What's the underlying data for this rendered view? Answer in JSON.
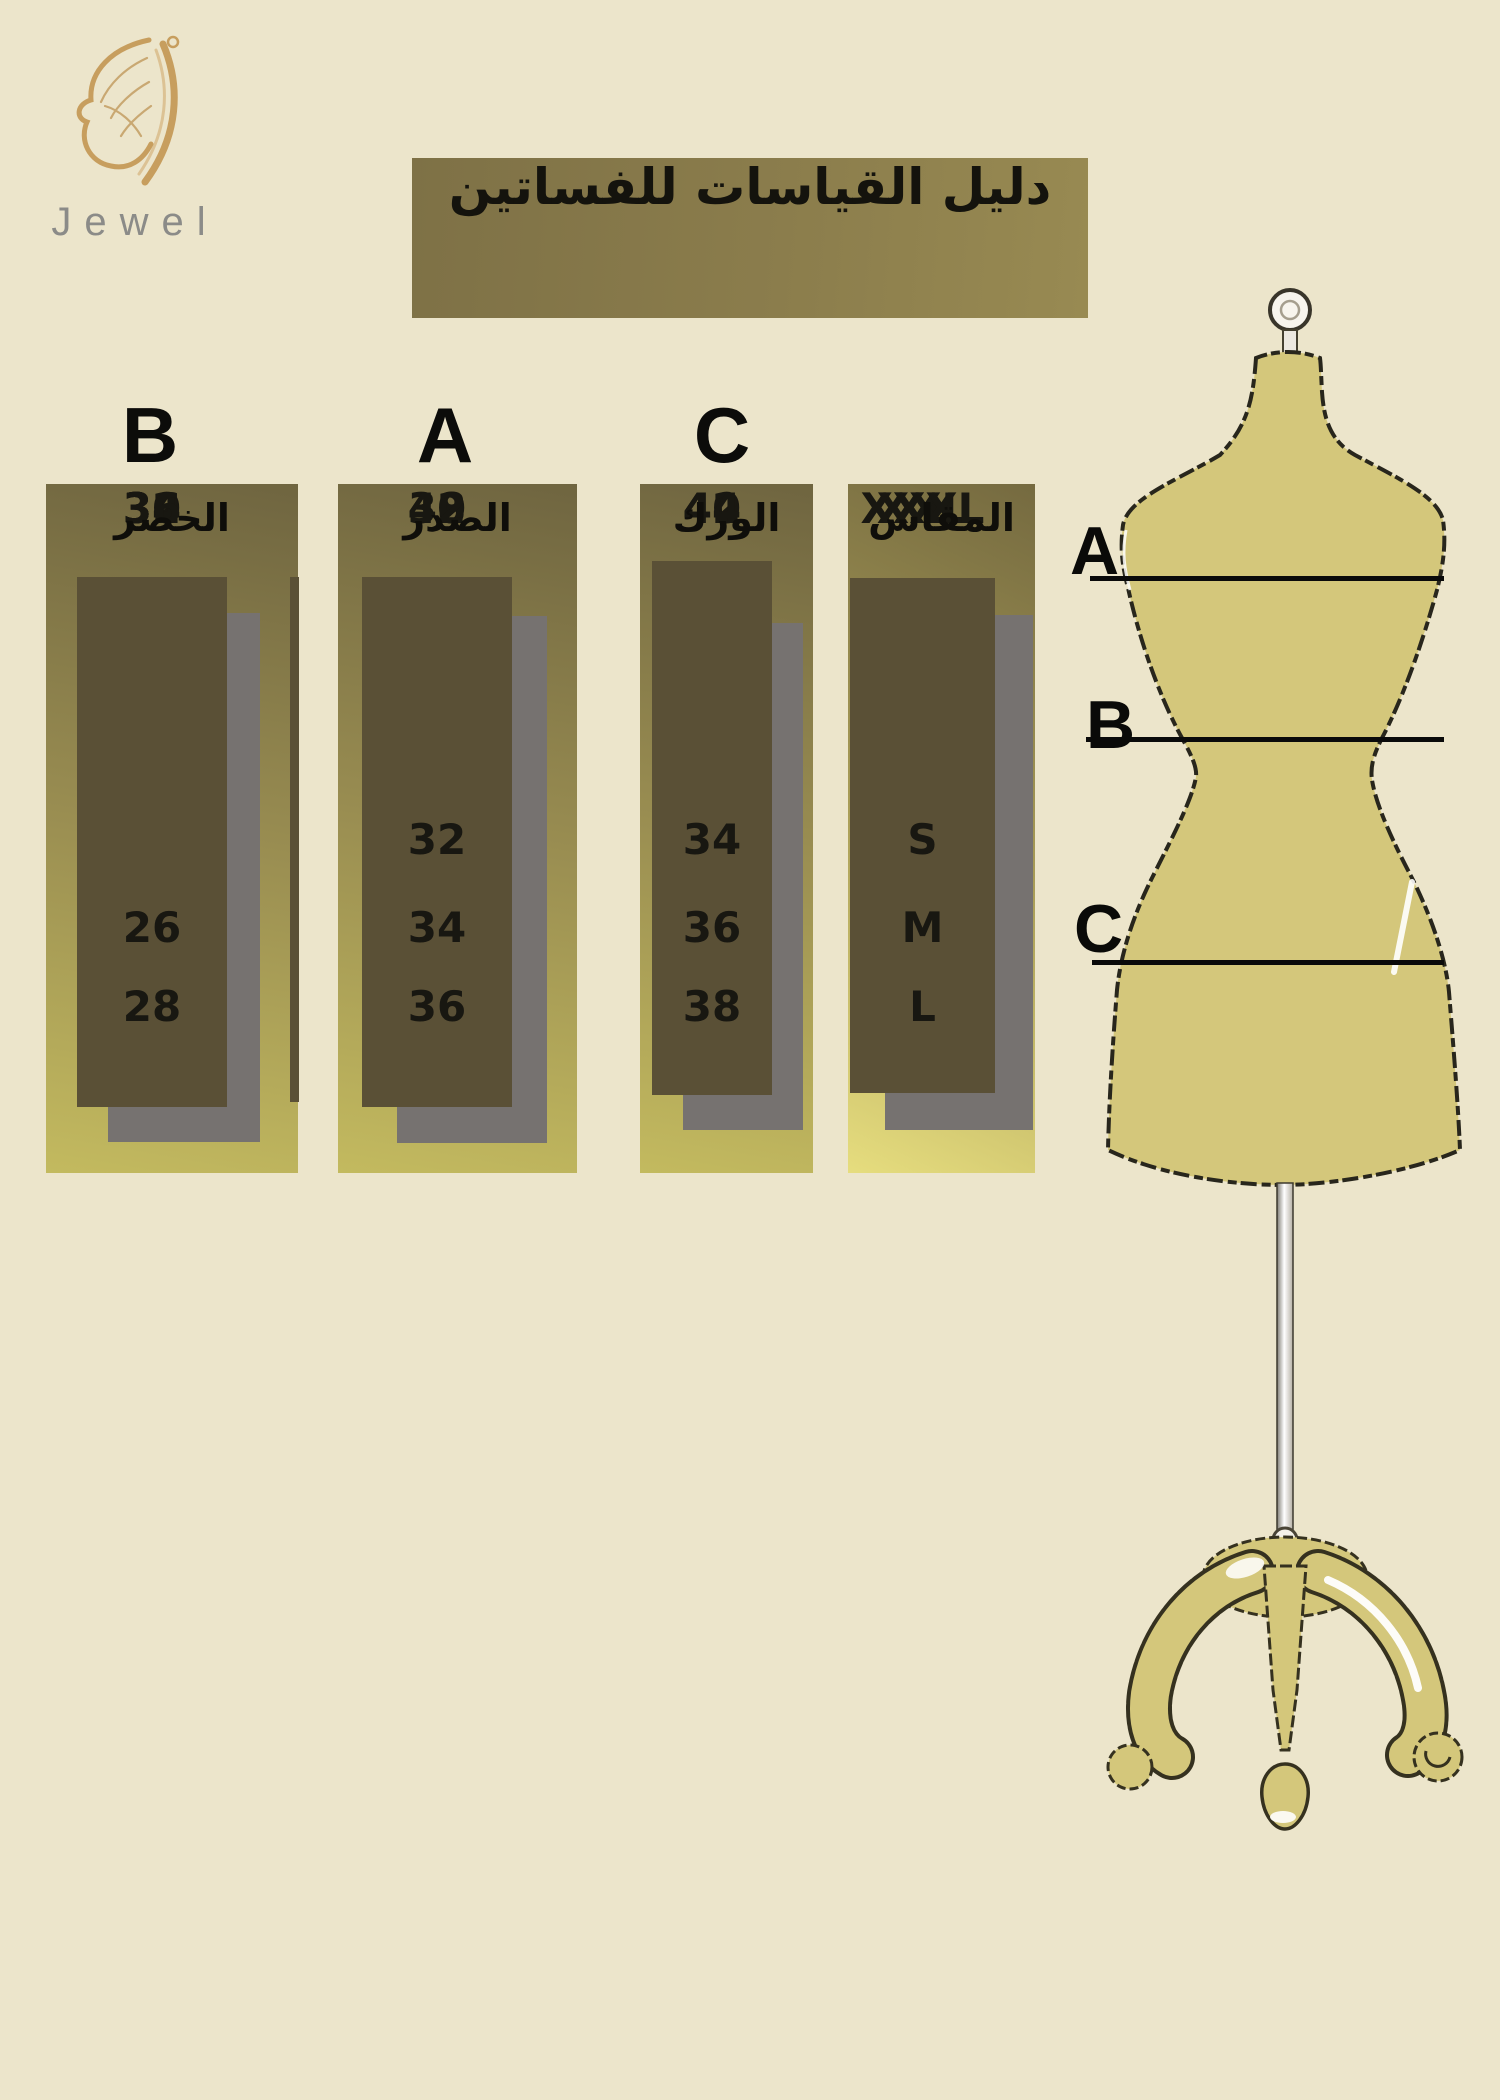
{
  "page": {
    "background": "#ece5cb"
  },
  "brand": {
    "name": "Jewel",
    "logo_icon": "butterfly-wing-icon",
    "logo_color": "#c79e5e",
    "name_color": "#8b8b88"
  },
  "title": {
    "text": "دليل القياسات للفساتين",
    "background": "#8b7d4c",
    "color": "#14130d"
  },
  "size_chart": {
    "columns": [
      {
        "letter": "B",
        "header": "الخصر",
        "values": [
          "26",
          "28",
          "30",
          "32",
          "34",
          "36"
        ]
      },
      {
        "letter": "A",
        "header": "الصدر",
        "values": [
          "32",
          "34",
          "36",
          "38",
          "40",
          "42"
        ]
      },
      {
        "letter": "C",
        "header": "الورك",
        "values": [
          "34",
          "36",
          "38",
          "40",
          "42",
          "44"
        ]
      },
      {
        "letter": "",
        "header": "المقاس",
        "values": [
          "S",
          "M",
          "L",
          "XL",
          "XXL",
          "XXXL"
        ]
      }
    ],
    "colors": {
      "box_gradient_top": "#6f6540",
      "box_gradient_bottom": "#c3ba5f",
      "size_box_bright_corner": "#e6dd7e",
      "inner_box": "#5a5036",
      "shadow": "#767270",
      "value_text": "#181711"
    }
  },
  "mannequin": {
    "labels": [
      {
        "text": "A"
      },
      {
        "text": "B"
      },
      {
        "text": "C"
      }
    ],
    "body_color": "#d4c77b",
    "outline_color": "#28261c",
    "line_color": "#0a0a0a"
  },
  "chart_data": {
    "type": "table",
    "title": "دليل القياسات للفساتين",
    "figure_labels": [
      "A",
      "B",
      "C"
    ],
    "columns": [
      {
        "letter": "B",
        "header": "الخصر",
        "values": [
          26,
          28,
          30,
          32,
          34,
          36
        ]
      },
      {
        "letter": "A",
        "header": "الصدر",
        "values": [
          32,
          34,
          36,
          38,
          40,
          42
        ]
      },
      {
        "letter": "C",
        "header": "الورك",
        "values": [
          34,
          36,
          38,
          40,
          42,
          44
        ]
      },
      {
        "letter": "",
        "header": "المقاس",
        "values": [
          "S",
          "M",
          "L",
          "XL",
          "XXL",
          "XXXL"
        ]
      }
    ]
  }
}
